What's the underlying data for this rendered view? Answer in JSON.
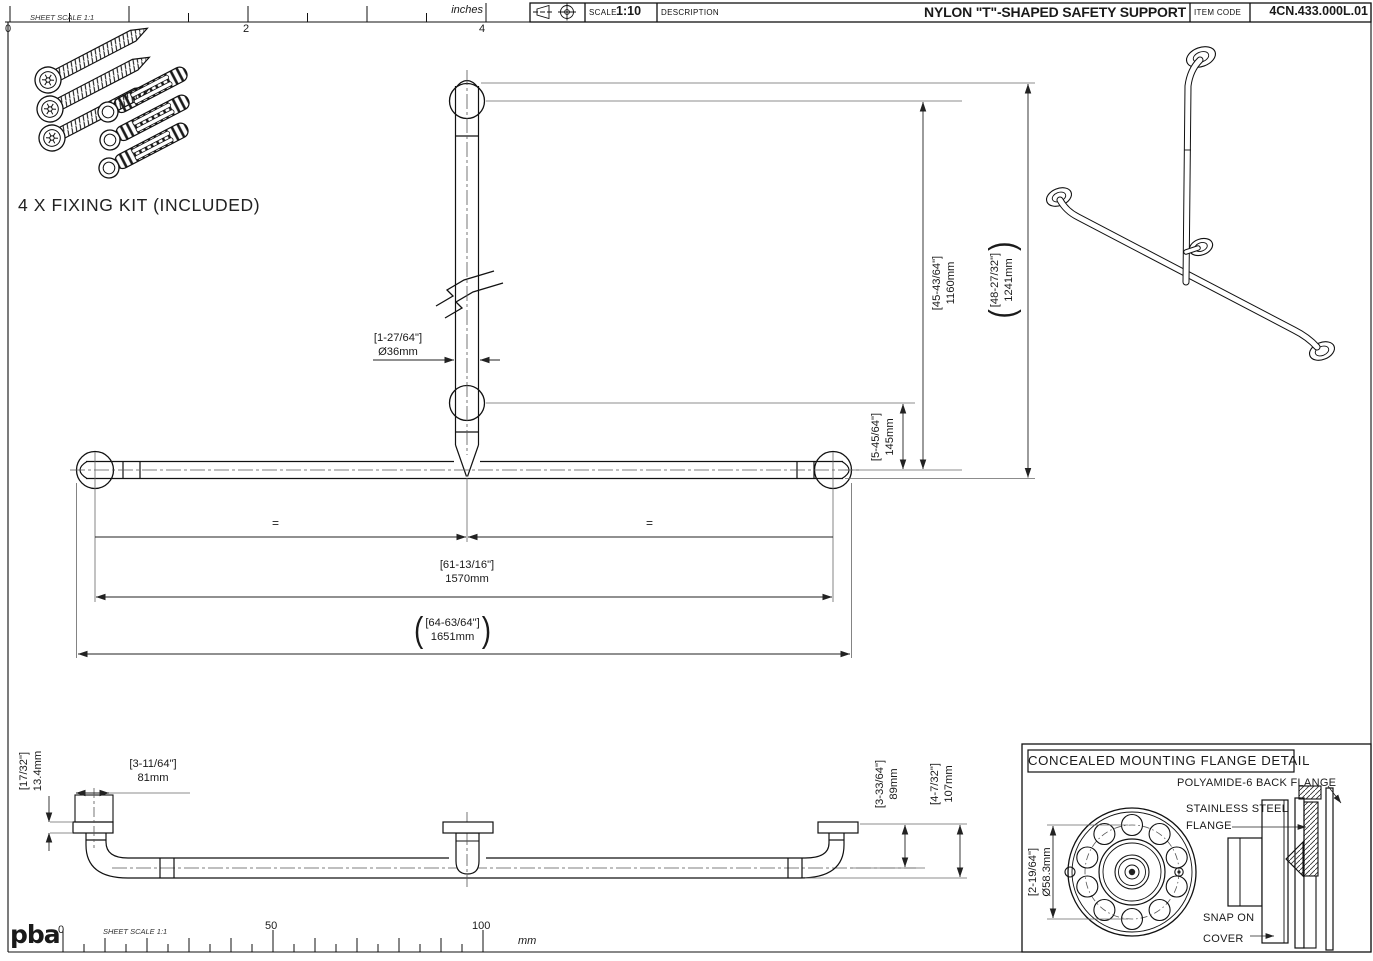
{
  "sheet": {
    "logo": "pba",
    "top_ruler": {
      "note": "SHEET SCALE 1:1",
      "unit": "inches",
      "t0": "0",
      "t2": "2",
      "t4": "4"
    },
    "bottom_ruler": {
      "note": "SHEET SCALE 1:1",
      "unit": "mm",
      "t0": "0",
      "t50": "50",
      "t100": "100"
    }
  },
  "title_block": {
    "scale_label": "SCALE",
    "scale_value": "1:10",
    "description_label": "DESCRIPTION",
    "title": "NYLON \"T\"-SHAPED SAFETY SUPPORT",
    "item_code_label": "ITEM CODE",
    "item_code": "4CN.433.000L.01"
  },
  "fixing_kit": {
    "label": "4 X FIXING KIT (INCLUDED)"
  },
  "symbols": {
    "open_paren": "(",
    "close_paren": ")",
    "equal": "="
  },
  "front_view": {
    "dims": {
      "tube_diameter": {
        "inch": "[1-27/64\"]",
        "mm": "Ø36mm"
      },
      "height_to_center": {
        "inch": "[45-43/64\"]",
        "mm": "1160mm"
      },
      "overall_height": {
        "inch": "[48-27/32\"]",
        "mm": "1241mm"
      },
      "mid_flange_drop": {
        "inch": "[5-45/64\"]",
        "mm": "145mm"
      },
      "center_span": {
        "inch": "[61-13/16\"]",
        "mm": "1570mm"
      },
      "overall_width": {
        "inch": "[64-63/64\"]",
        "mm": "1651mm"
      }
    }
  },
  "side_view": {
    "dims": {
      "flange_thickness": {
        "inch": "[17/32\"]",
        "mm": "13.4mm"
      },
      "flange_offset": {
        "inch": "[3-11/64\"]",
        "mm": "81mm"
      },
      "wall_to_center": {
        "inch": "[3-33/64\"]",
        "mm": "89mm"
      },
      "wall_to_outer": {
        "inch": "[4-7/32\"]",
        "mm": "107mm"
      }
    }
  },
  "flange_detail": {
    "title": "CONCEALED MOUNTING FLANGE DETAIL",
    "bolt_circle": {
      "inch": "[2-19/64\"]",
      "mm": "Ø58.3mm"
    },
    "labels": {
      "back_flange": "POLYAMIDE-6 BACK FLANGE",
      "steel_flange_1": "STAINLESS STEEL",
      "steel_flange_2": "FLANGE",
      "snap_cover_1": "SNAP ON",
      "snap_cover_2": "COVER"
    }
  }
}
